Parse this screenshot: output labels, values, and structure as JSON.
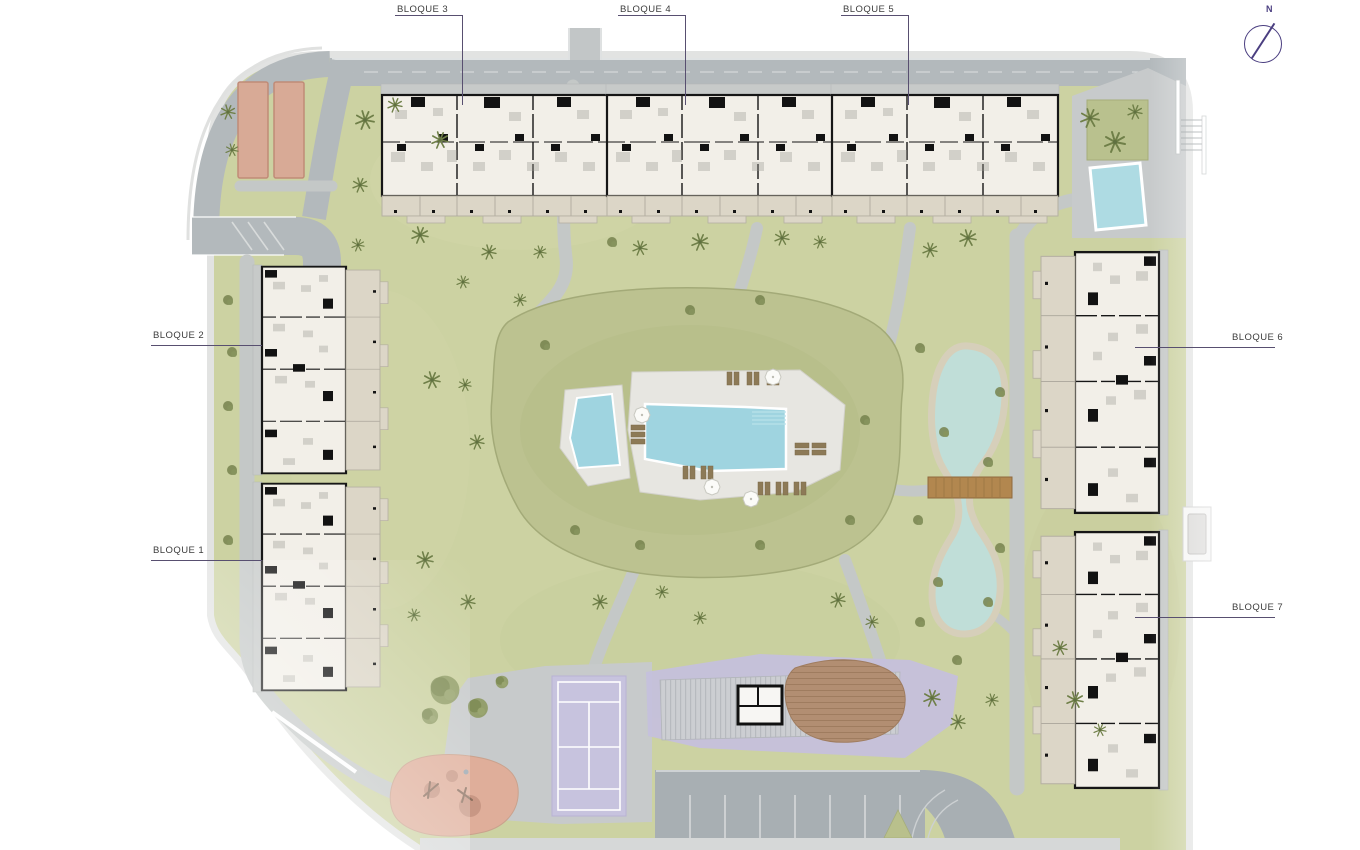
{
  "labels": {
    "bloque_1": "BLOQUE 1",
    "bloque_2": "BLOQUE 2",
    "bloque_3": "BLOQUE 3",
    "bloque_4": "BLOQUE 4",
    "bloque_5": "BLOQUE 5",
    "bloque_6": "BLOQUE 6",
    "bloque_7": "BLOQUE 7"
  },
  "compass": {
    "north_label": "N"
  },
  "theme": {
    "colors": {
      "background": "#ffffff",
      "grass": "#ccd2a2",
      "mound_green": "#bcc290",
      "road_gray": "#b3b9bc",
      "path_gray": "#c4c8c7",
      "plaza_gray": "#c7cacb",
      "parking_gray": "#a8afb3",
      "building_floor": "#f2efe8",
      "building_wall": "#161616",
      "terrace_beige": "#dcd6c7",
      "roof_gray": "#c7cac9",
      "pool_blue": "#9fd4e0",
      "lake_aqua": "#c0ded8",
      "lake_shore": "#d6cfba",
      "purple_zone": "#c5c0dc",
      "court_purple": "#c7c3de",
      "salmon": "#d8aa96",
      "playground_salmon": "#dfae9a",
      "wood_brown": "#b2874f",
      "deck_brown": "#b28e72",
      "label_text": "#3c3c3c",
      "leader_line": "#584f70",
      "compass_purple": "#4a3e80"
    }
  }
}
